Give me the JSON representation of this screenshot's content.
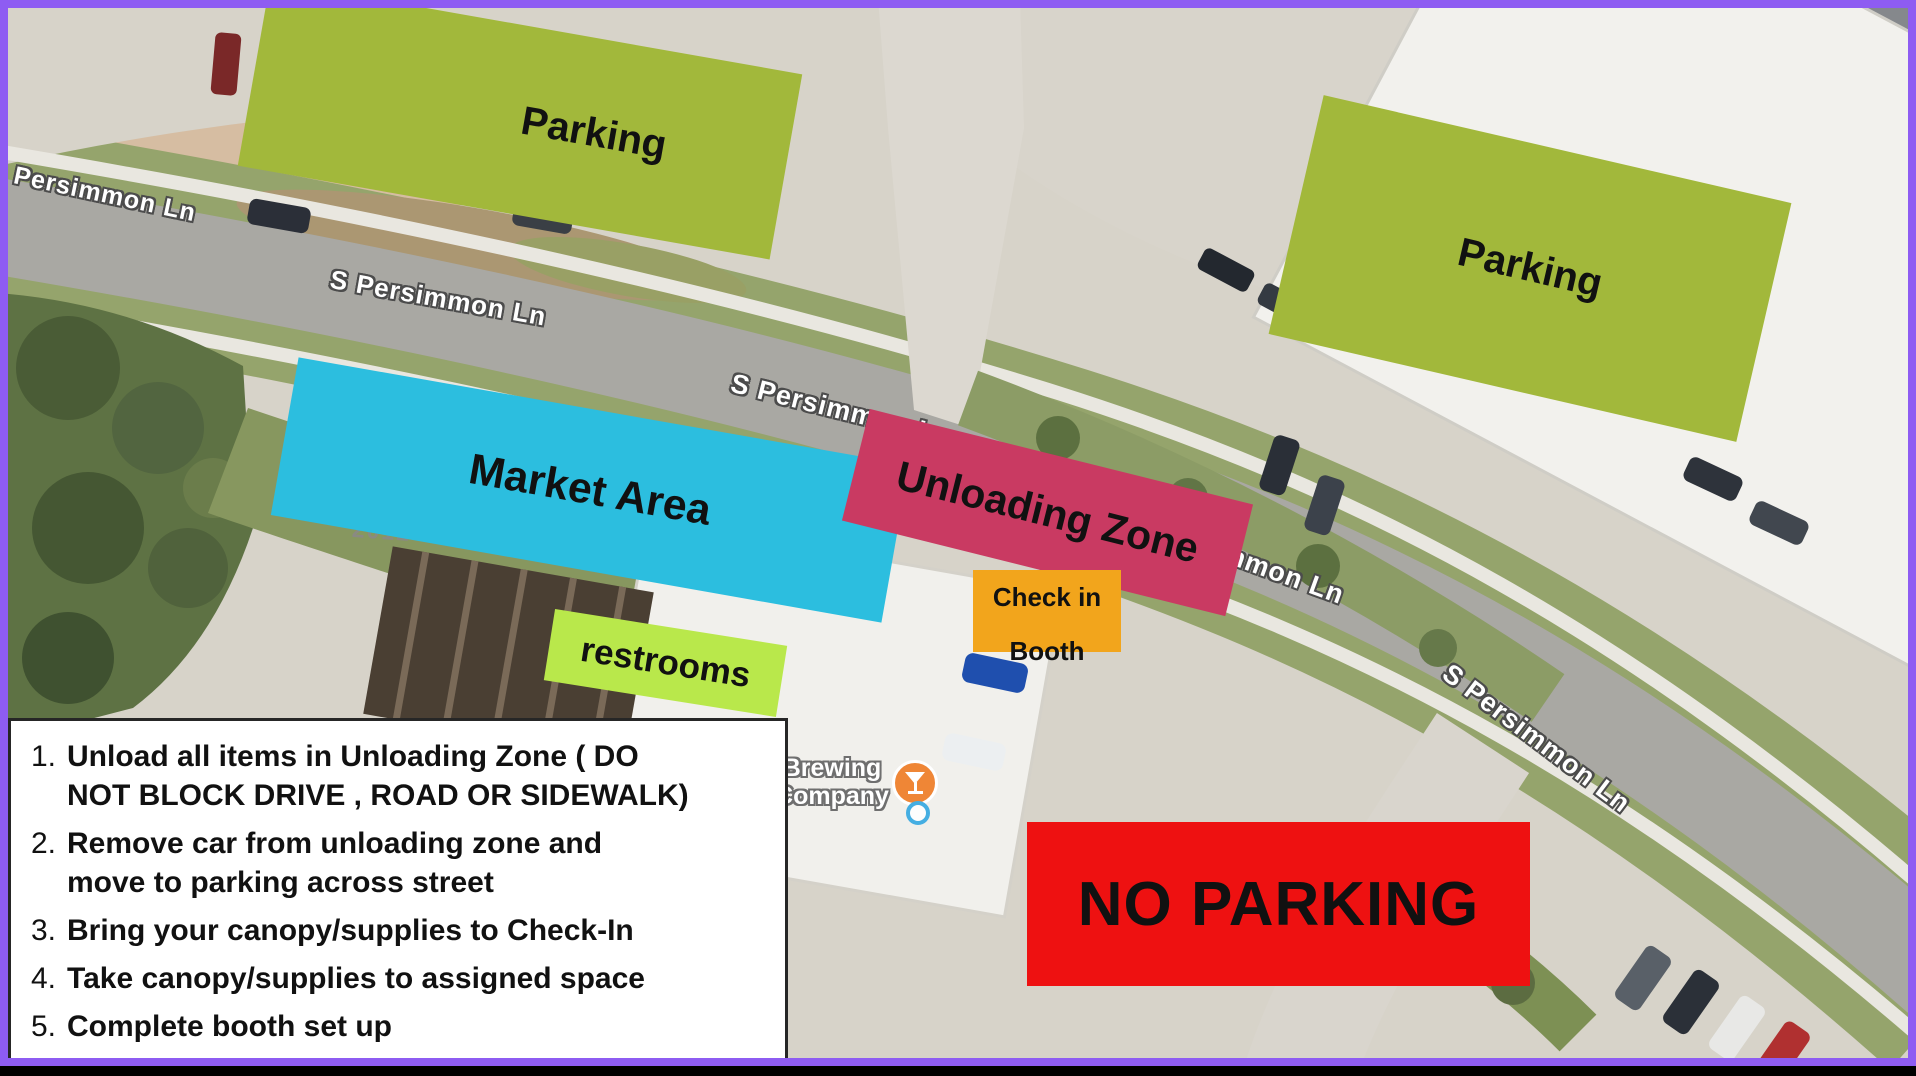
{
  "frame": {
    "border_color": "#8e5cf2"
  },
  "map": {
    "street_labels": [
      {
        "text": "S Persimmon Ln"
      },
      {
        "text": "S Persimmon Ln"
      },
      {
        "text": "S Persimmon Ln"
      },
      {
        "text": "S Persimmon Ln"
      },
      {
        "text": "S Persimmon Ln"
      }
    ],
    "address_label": "2012",
    "poi": {
      "name_line1": "Brewing",
      "name_line2": "Company",
      "icon": "cocktail-glass-icon",
      "pin_color": "#ef8636",
      "dot_color": "#45aee2"
    }
  },
  "zones": {
    "parking_nw": {
      "label": "Parking",
      "color": "#a2b83b"
    },
    "parking_ne": {
      "label": "Parking",
      "color": "#a2b83b"
    },
    "market_area": {
      "label": "Market Area",
      "color": "#2cbedf"
    },
    "unloading_zone": {
      "label": "Unloading Zone",
      "color": "#c93a62"
    },
    "check_in_booth": {
      "label_line1": "Check in",
      "label_line2": "Booth",
      "color": "#f2a51c"
    },
    "restrooms": {
      "label": "restrooms",
      "color": "#b9e84b"
    },
    "no_parking": {
      "label": "NO PARKING",
      "color": "#ee1111"
    }
  },
  "instructions": {
    "items": [
      {
        "num": "1.",
        "lines": [
          "Unload all items in Unloading Zone ( DO",
          "NOT BLOCK DRIVE , ROAD OR SIDEWALK)"
        ]
      },
      {
        "num": "2.",
        "lines": [
          " Remove car from unloading zone and",
          "move to parking across street"
        ]
      },
      {
        "num": "3.",
        "lines": [
          "Bring your canopy/supplies to Check-In"
        ]
      },
      {
        "num": "4.",
        "lines": [
          "Take canopy/supplies to assigned space"
        ]
      },
      {
        "num": "5.",
        "lines": [
          "Complete booth set up"
        ]
      }
    ]
  }
}
